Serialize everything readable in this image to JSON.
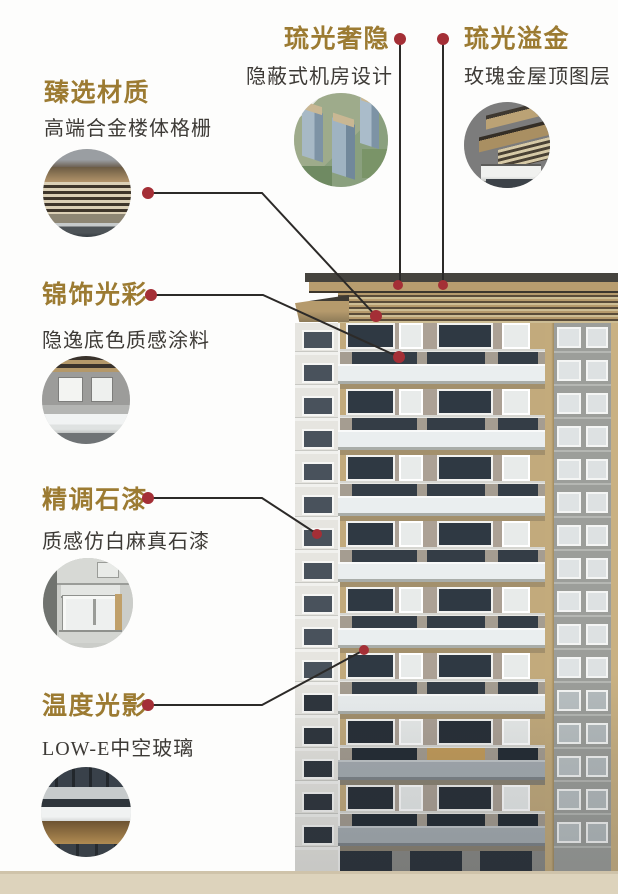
{
  "infographic": {
    "callouts": [
      {
        "title": "臻选材质",
        "subtitle": "高端合金楼体格栅",
        "thumbnail": "metal-grille-closeup"
      },
      {
        "title": "锦饰光彩",
        "subtitle": "隐逸底色质感涂料",
        "thumbnail": "facade-coating-closeup"
      },
      {
        "title": "精调石漆",
        "subtitle": "质感仿白麻真石漆",
        "thumbnail": "stone-paint-window-closeup"
      },
      {
        "title": "温度光影",
        "subtitle": "LOW-E中空玻璃",
        "thumbnail": "lowe-glass-closeup"
      },
      {
        "title": "琉光奢隐",
        "subtitle": "隐蔽式机房设计",
        "thumbnail": "aerial-towers-view"
      },
      {
        "title": "琉光溢金",
        "subtitle": "玫瑰金屋顶图层",
        "thumbnail": "rosegold-roof-closeup"
      }
    ],
    "colors": {
      "accent_gold": "#9c7b32",
      "marker_red": "#a42f36",
      "leader_line": "#2c2a28",
      "ground_beige": "#ddd3bc",
      "background": "#fdfdfc"
    }
  }
}
